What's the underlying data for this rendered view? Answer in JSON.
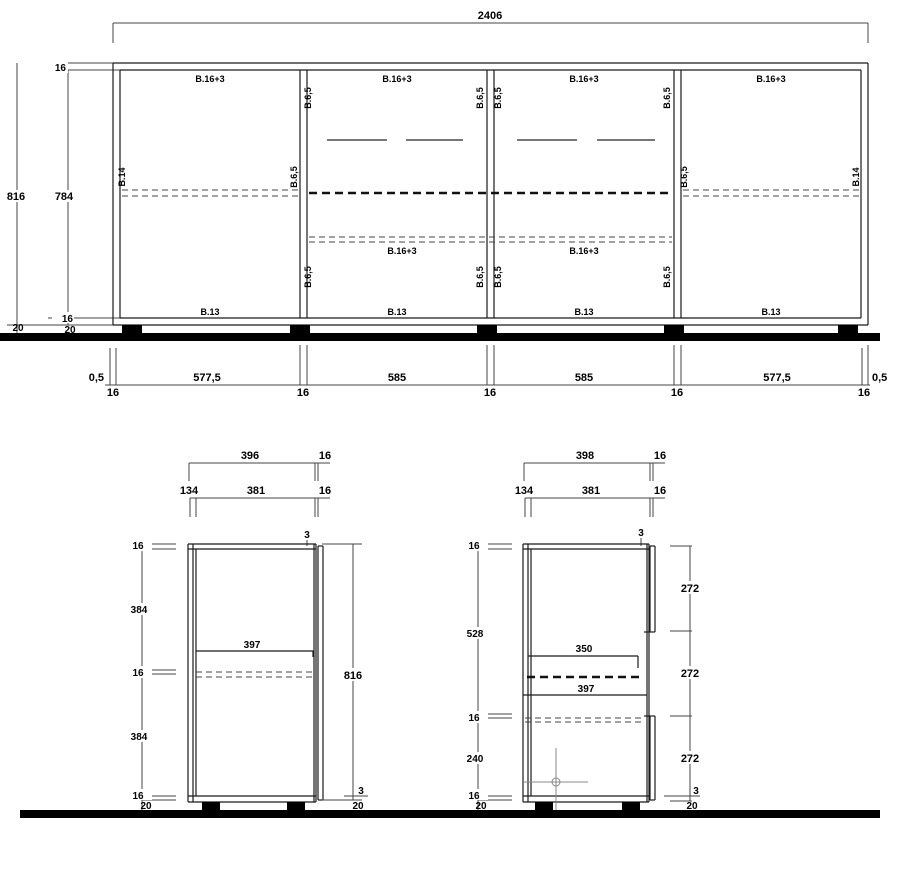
{
  "front_view": {
    "total_width": "2406",
    "heights": {
      "total": "816",
      "carcass": "784",
      "top_panel": "16",
      "bottom_panel": "16",
      "plinth_front": "20",
      "plinth_back": "20"
    },
    "bottom_dims": {
      "gap_left": "0,5",
      "gap_right": "0,5",
      "bays": [
        "577,5",
        "585",
        "585",
        "577,5"
      ],
      "panel_ticks": [
        "16",
        "16",
        "16",
        "16",
        "16"
      ]
    },
    "part_labels": {
      "top_panel": "B.16+3",
      "shelf": "B.16+3",
      "bottom_panel": "B.13",
      "side_panel": "B.14",
      "divider": "B.6,5"
    }
  },
  "left_section": {
    "top_dims": {
      "overall": "396",
      "overall_door": "16",
      "back": "134",
      "inner": "381",
      "inner_door": "16"
    },
    "height_chain": [
      "16",
      "384",
      "16",
      "384",
      "16",
      "20"
    ],
    "total_height": "816",
    "shelf_depth": "397",
    "door_gap_top": "3",
    "door_gap_bottom": "3",
    "plinth": "20"
  },
  "right_section": {
    "top_dims": {
      "overall": "398",
      "overall_door": "16",
      "back": "134",
      "inner": "381",
      "inner_door": "16"
    },
    "height_chain": [
      "16",
      "528",
      "16",
      "240",
      "16",
      "20"
    ],
    "front_heights": [
      "272",
      "272",
      "272"
    ],
    "rail_depth": "350",
    "shelf_depth": "397",
    "door_gap_top": "3",
    "door_gap_bottom": "3",
    "plinth": "20"
  }
}
